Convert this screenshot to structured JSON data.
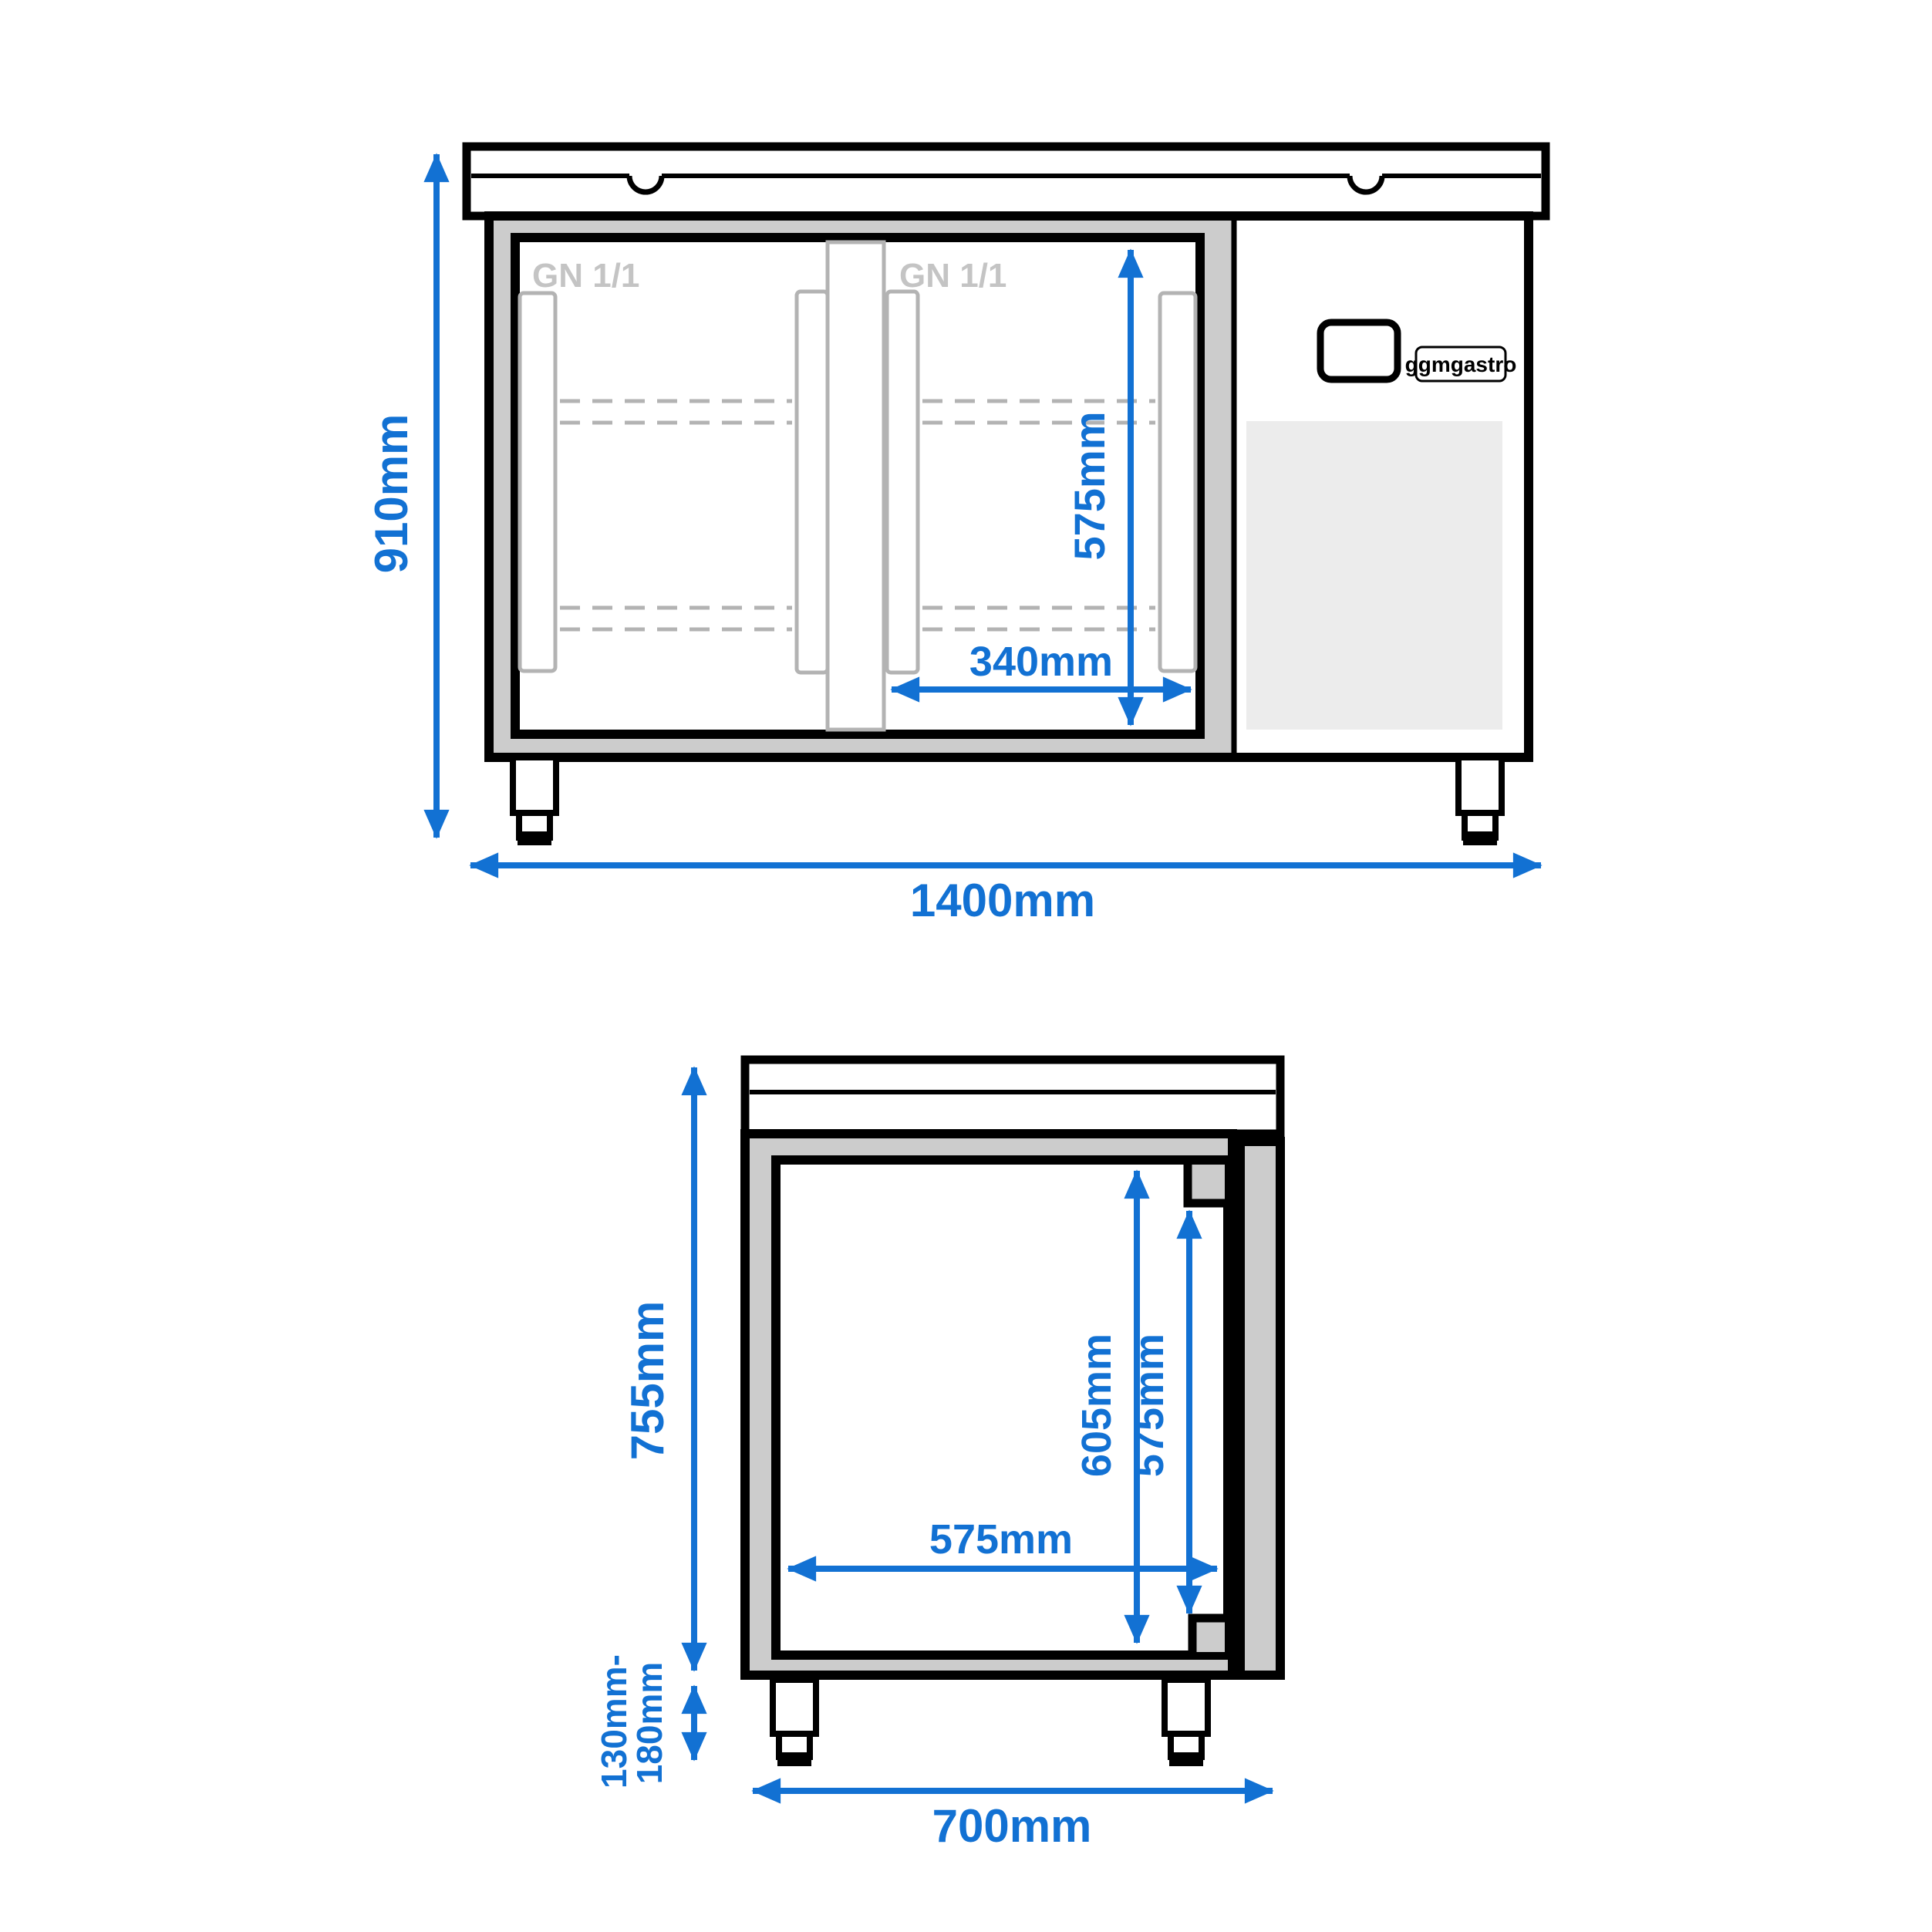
{
  "drawing_type": "technical-dimension-drawing",
  "views": {
    "front": {
      "labels": {
        "height": "910mm",
        "width": "1400mm",
        "inner_height": "575mm",
        "door_width": "340mm",
        "gn_left": "GN 1/1",
        "gn_right": "GN 1/1",
        "brand": "ggmgastro"
      }
    },
    "side": {
      "labels": {
        "height": "755mm",
        "depth": "700mm",
        "inner_height_full": "605mm",
        "inner_height_door": "575mm",
        "inner_depth": "575mm",
        "feet_min": "130mm-",
        "feet_max": "180mm"
      }
    }
  },
  "colors": {
    "dimension_blue": "#1271d3",
    "outline_black": "#000000",
    "frame_gray": "#cccccc",
    "bar_gray": "#b3b3b3",
    "label_gray": "#c4c4c4",
    "vent_gray": "#ececec",
    "background": "#ffffff"
  }
}
